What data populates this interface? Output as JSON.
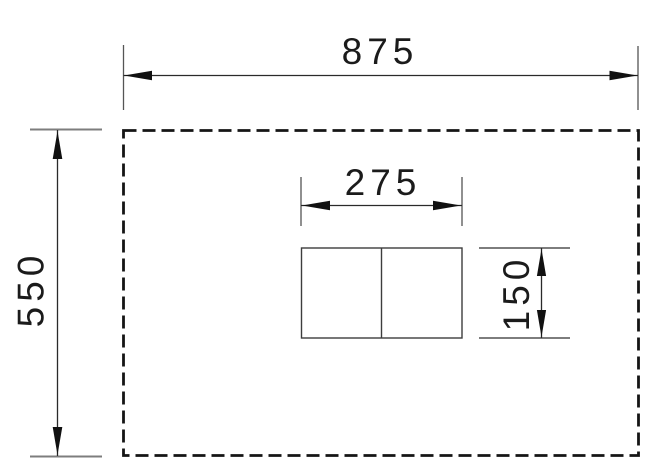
{
  "drawing": {
    "type": "technical-dimension-drawing",
    "description": "Dashed panel outline with centered two-part cutout rectangle and four linear dimensions",
    "labels": {
      "panel_width": "875",
      "panel_height": "550",
      "cutout_width": "275",
      "cutout_height": "150"
    }
  },
  "colors": {
    "line": "#151515",
    "thin-line": "#3d3d3d",
    "dim-line": "#2a2a2a",
    "ext-dark": "#555555",
    "ext-gray": "#7d7d7d",
    "arrow": "#111111",
    "text": "#1b1b1b",
    "background": "#ffffff"
  }
}
